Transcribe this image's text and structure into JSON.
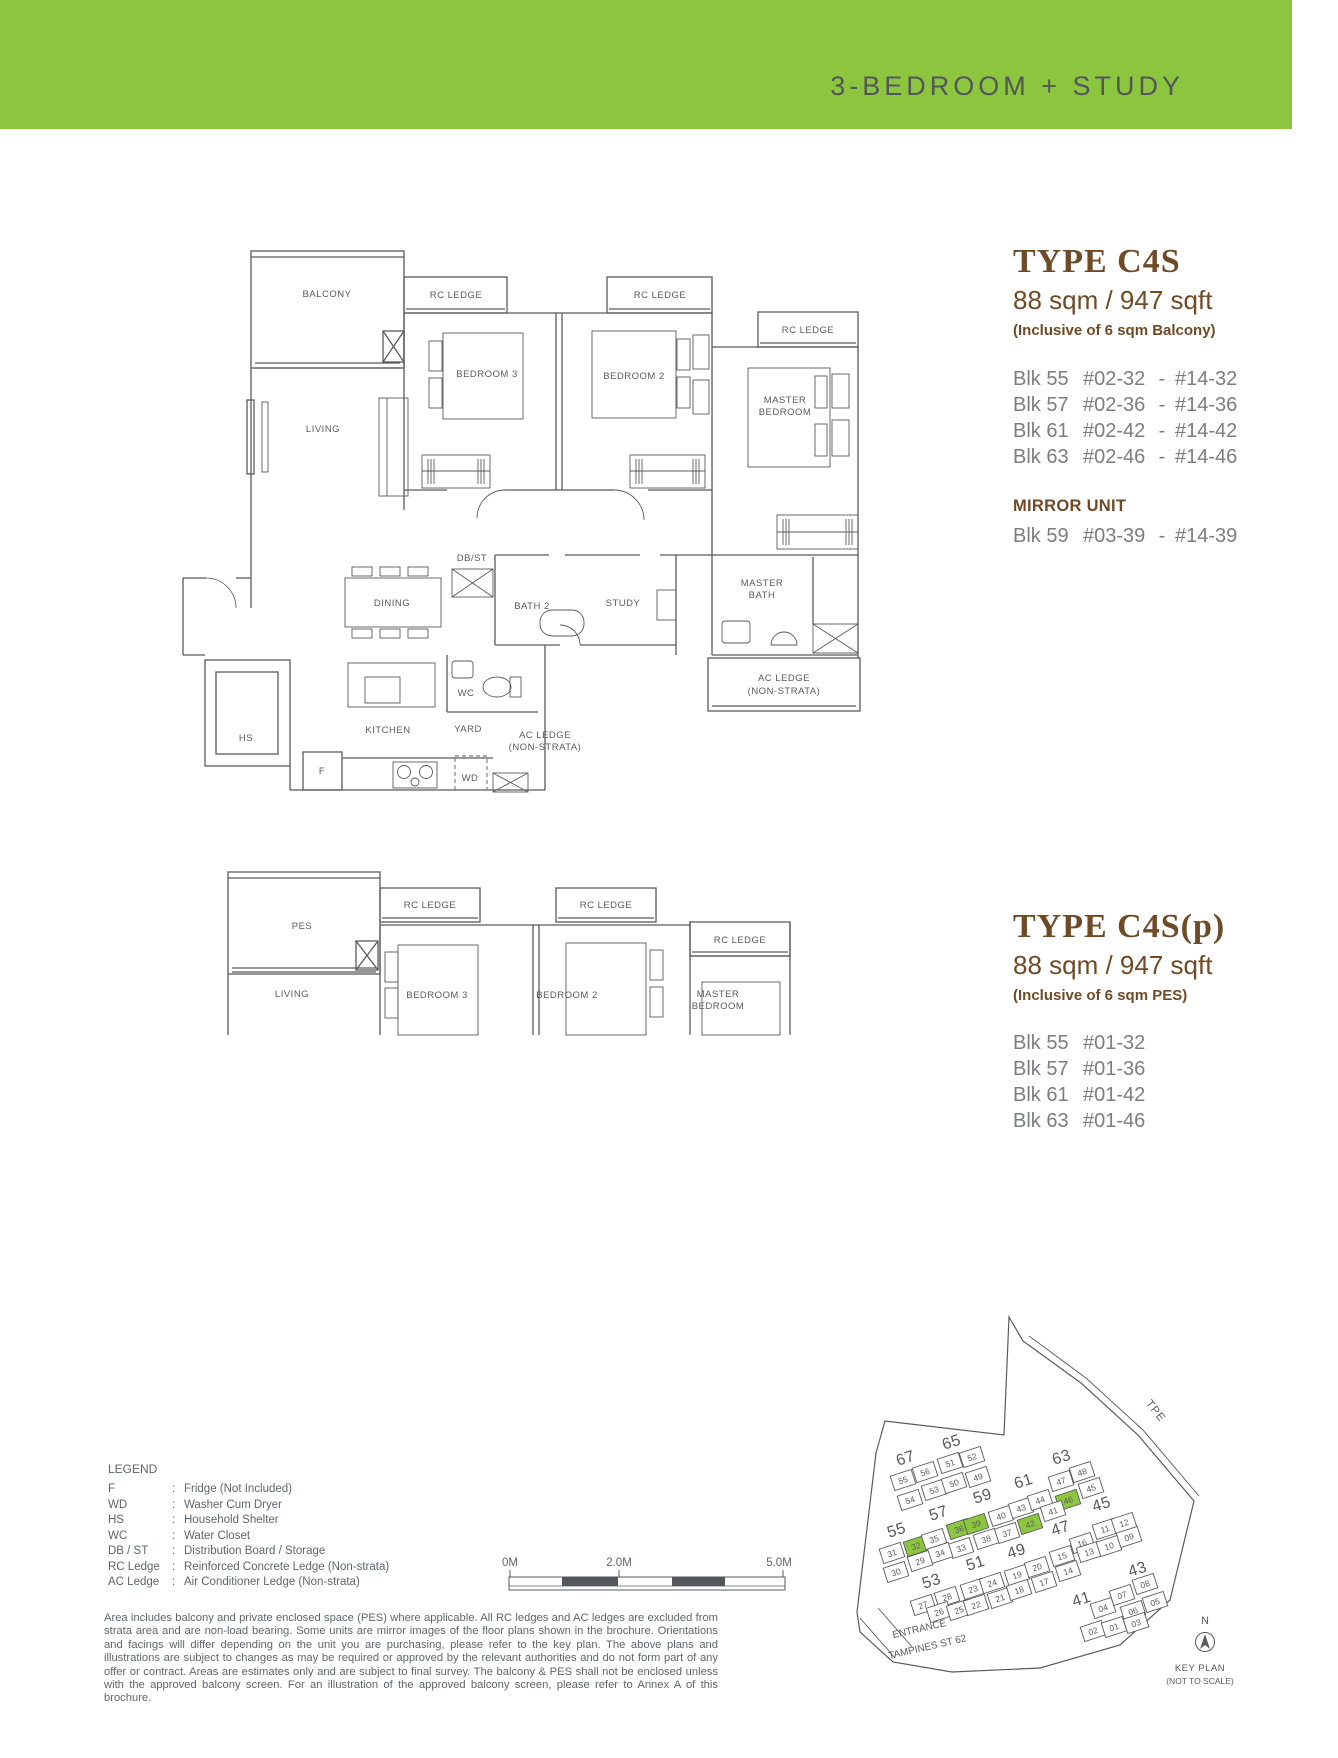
{
  "header": {
    "title": "3-BEDROOM + STUDY",
    "bg_color": "#8CC63F"
  },
  "type_c4s": {
    "title": "TYPE C4S",
    "area": "88 sqm / 947 sqft",
    "note": "(Inclusive of 6 sqm Balcony)",
    "range_separator": "-",
    "units": [
      {
        "blk": "Blk 55",
        "from": "#02-32",
        "to": "#14-32"
      },
      {
        "blk": "Blk 57",
        "from": "#02-36",
        "to": "#14-36"
      },
      {
        "blk": "Blk 61",
        "from": "#02-42",
        "to": "#14-42"
      },
      {
        "blk": "Blk 63",
        "from": "#02-46",
        "to": "#14-46"
      }
    ],
    "mirror_title": "MIRROR UNIT",
    "mirror_units": [
      {
        "blk": "Blk 59",
        "from": "#03-39",
        "to": "#14-39"
      }
    ]
  },
  "type_c4sp": {
    "title": "TYPE C4S(p)",
    "area": "88 sqm / 947 sqft",
    "note": "(Inclusive of 6 sqm PES)",
    "units": [
      {
        "blk": "Blk 55",
        "from": "#01-32"
      },
      {
        "blk": "Blk 57",
        "from": "#01-36"
      },
      {
        "blk": "Blk 61",
        "from": "#01-42"
      },
      {
        "blk": "Blk 63",
        "from": "#01-46"
      }
    ]
  },
  "floorplan_main": {
    "labels": [
      {
        "t": "BALCONY",
        "x": 327,
        "y": 297
      },
      {
        "t": "RC LEDGE",
        "x": 456,
        "y": 298
      },
      {
        "t": "RC LEDGE",
        "x": 660,
        "y": 298
      },
      {
        "t": "RC LEDGE",
        "x": 808,
        "y": 333
      },
      {
        "t": "BEDROOM 3",
        "x": 487,
        "y": 377
      },
      {
        "t": "BEDROOM 2",
        "x": 634,
        "y": 379
      },
      {
        "t": "MASTER",
        "x": 785,
        "y": 403
      },
      {
        "t": "BEDROOM",
        "x": 785,
        "y": 415
      },
      {
        "t": "LIVING",
        "x": 323,
        "y": 432
      },
      {
        "t": "DINING",
        "x": 392,
        "y": 606
      },
      {
        "t": "DB/ST",
        "x": 472,
        "y": 561,
        "fs": 9
      },
      {
        "t": "BATH 2",
        "x": 532,
        "y": 609
      },
      {
        "t": "STUDY",
        "x": 623,
        "y": 606
      },
      {
        "t": "MASTER",
        "x": 762,
        "y": 586
      },
      {
        "t": "BATH",
        "x": 762,
        "y": 598
      },
      {
        "t": "WC",
        "x": 466,
        "y": 696,
        "fs": 9
      },
      {
        "t": "HS",
        "x": 246,
        "y": 741
      },
      {
        "t": "KITCHEN",
        "x": 388,
        "y": 733
      },
      {
        "t": "YARD",
        "x": 468,
        "y": 732
      },
      {
        "t": "AC LEDGE",
        "x": 545,
        "y": 738,
        "fs": 9
      },
      {
        "t": "(NON-STRATA)",
        "x": 545,
        "y": 750,
        "fs": 9
      },
      {
        "t": "AC LEDGE",
        "x": 784,
        "y": 681
      },
      {
        "t": "(NON-STRATA)",
        "x": 784,
        "y": 694
      },
      {
        "t": "F",
        "x": 322,
        "y": 774,
        "fs": 9
      },
      {
        "t": "WD",
        "x": 470,
        "y": 781,
        "fs": 9
      }
    ]
  },
  "floorplan_pes": {
    "labels": [
      {
        "t": "PES",
        "x": 302,
        "y": 929
      },
      {
        "t": "RC LEDGE",
        "x": 430,
        "y": 908
      },
      {
        "t": "RC LEDGE",
        "x": 606,
        "y": 908
      },
      {
        "t": "RC LEDGE",
        "x": 740,
        "y": 943
      },
      {
        "t": "LIVING",
        "x": 292,
        "y": 997
      },
      {
        "t": "BEDROOM 3",
        "x": 437,
        "y": 998
      },
      {
        "t": "BEDROOM 2",
        "x": 567,
        "y": 998
      },
      {
        "t": "MASTER",
        "x": 718,
        "y": 997
      },
      {
        "t": "BEDROOM",
        "x": 718,
        "y": 1009
      }
    ]
  },
  "legend": {
    "title": "LEGEND",
    "items": [
      {
        "abbr": "F",
        "desc": "Fridge (Not Included)"
      },
      {
        "abbr": "WD",
        "desc": "Washer Cum Dryer"
      },
      {
        "abbr": "HS",
        "desc": "Household Shelter"
      },
      {
        "abbr": "WC",
        "desc": "Water Closet"
      },
      {
        "abbr": "DB / ST",
        "desc": "Distribution Board / Storage"
      },
      {
        "abbr": "RC Ledge",
        "desc": "Reinforced Concrete Ledge (Non-strata)"
      },
      {
        "abbr": "AC Ledge",
        "desc": "Air Conditioner Ledge (Non-strata)"
      }
    ]
  },
  "scalebar": {
    "labels": [
      "0M",
      "2.0M",
      "5.0M"
    ]
  },
  "disclaimer": "Area includes balcony and private enclosed space (PES) where applicable. All RC ledges and AC ledges are excluded from strata area and are non-load bearing. Some units are mirror images of the floor plans shown in the brochure. Orientations and facings will differ depending on the unit you are purchasing, please refer to the key plan. The above plans and illustrations are subject to changes as may be required or approved by the relevant authorities and do not form part of any offer or contract. Areas are estimates only and are subject to final survey. The balcony & PES shall not be enclosed unless with the approved balcony screen. For an illustration of the approved balcony screen, please refer to Annex A of this brochure.",
  "keyplan": {
    "road_label": "TPE",
    "entrance_line1": "ENTRANCE",
    "entrance_line2": "TAMPINES ST 62",
    "north_label": "N",
    "caption_line1": "KEY PLAN",
    "caption_line2": "(NOT TO SCALE)",
    "highlight_color": "#8CC63F",
    "blocks": [
      {
        "label": "67",
        "x": 907,
        "y": 1463
      },
      {
        "label": "65",
        "x": 953,
        "y": 1447
      },
      {
        "label": "55",
        "x": 898,
        "y": 1535
      },
      {
        "label": "57",
        "x": 940,
        "y": 1518
      },
      {
        "label": "59",
        "x": 984,
        "y": 1501
      },
      {
        "label": "61",
        "x": 1025,
        "y": 1486
      },
      {
        "label": "63",
        "x": 1063,
        "y": 1462
      },
      {
        "label": "47",
        "x": 1062,
        "y": 1533
      },
      {
        "label": "45",
        "x": 1103,
        "y": 1509
      },
      {
        "label": "53",
        "x": 933,
        "y": 1586
      },
      {
        "label": "51",
        "x": 977,
        "y": 1568
      },
      {
        "label": "49",
        "x": 1018,
        "y": 1556
      },
      {
        "label": "41",
        "x": 1083,
        "y": 1604
      },
      {
        "label": "43",
        "x": 1139,
        "y": 1574
      }
    ],
    "units": [
      {
        "n": "55",
        "x": 903,
        "y": 1480
      },
      {
        "n": "56",
        "x": 925,
        "y": 1472
      },
      {
        "n": "51",
        "x": 950,
        "y": 1463
      },
      {
        "n": "52",
        "x": 972,
        "y": 1457
      },
      {
        "n": "54",
        "x": 910,
        "y": 1500
      },
      {
        "n": "53",
        "x": 934,
        "y": 1490
      },
      {
        "n": "50",
        "x": 954,
        "y": 1483
      },
      {
        "n": "49",
        "x": 978,
        "y": 1477
      },
      {
        "n": "31",
        "x": 892,
        "y": 1553
      },
      {
        "n": "32",
        "x": 916,
        "y": 1546,
        "hl": true
      },
      {
        "n": "35",
        "x": 934,
        "y": 1539
      },
      {
        "n": "36",
        "x": 959,
        "y": 1529,
        "hl": true
      },
      {
        "n": "39",
        "x": 976,
        "y": 1524,
        "hl": true
      },
      {
        "n": "40",
        "x": 1001,
        "y": 1516
      },
      {
        "n": "43",
        "x": 1021,
        "y": 1508
      },
      {
        "n": "44",
        "x": 1040,
        "y": 1500
      },
      {
        "n": "47",
        "x": 1061,
        "y": 1481
      },
      {
        "n": "48",
        "x": 1082,
        "y": 1472
      },
      {
        "n": "45",
        "x": 1091,
        "y": 1488
      },
      {
        "n": "46",
        "x": 1068,
        "y": 1500,
        "hl": true
      },
      {
        "n": "41",
        "x": 1053,
        "y": 1511
      },
      {
        "n": "42",
        "x": 1030,
        "y": 1524,
        "hl": true
      },
      {
        "n": "37",
        "x": 1007,
        "y": 1533
      },
      {
        "n": "38",
        "x": 986,
        "y": 1539
      },
      {
        "n": "33",
        "x": 961,
        "y": 1548
      },
      {
        "n": "34",
        "x": 940,
        "y": 1553
      },
      {
        "n": "29",
        "x": 920,
        "y": 1561
      },
      {
        "n": "30",
        "x": 896,
        "y": 1572
      },
      {
        "n": "27",
        "x": 923,
        "y": 1605
      },
      {
        "n": "28",
        "x": 947,
        "y": 1597
      },
      {
        "n": "23",
        "x": 973,
        "y": 1589
      },
      {
        "n": "24",
        "x": 992,
        "y": 1583
      },
      {
        "n": "19",
        "x": 1017,
        "y": 1575
      },
      {
        "n": "20",
        "x": 1037,
        "y": 1567
      },
      {
        "n": "15",
        "x": 1062,
        "y": 1556
      },
      {
        "n": "16",
        "x": 1082,
        "y": 1543
      },
      {
        "n": "11",
        "x": 1105,
        "y": 1529
      },
      {
        "n": "12",
        "x": 1124,
        "y": 1523
      },
      {
        "n": "26",
        "x": 939,
        "y": 1612
      },
      {
        "n": "25",
        "x": 959,
        "y": 1610
      },
      {
        "n": "22",
        "x": 976,
        "y": 1605
      },
      {
        "n": "21",
        "x": 1000,
        "y": 1598
      },
      {
        "n": "18",
        "x": 1019,
        "y": 1590
      },
      {
        "n": "17",
        "x": 1044,
        "y": 1582
      },
      {
        "n": "14",
        "x": 1068,
        "y": 1571
      },
      {
        "n": "13",
        "x": 1089,
        "y": 1552
      },
      {
        "n": "10",
        "x": 1109,
        "y": 1546
      },
      {
        "n": "09",
        "x": 1129,
        "y": 1537
      },
      {
        "n": "04",
        "x": 1103,
        "y": 1608
      },
      {
        "n": "07",
        "x": 1122,
        "y": 1595
      },
      {
        "n": "08",
        "x": 1145,
        "y": 1584
      },
      {
        "n": "06",
        "x": 1133,
        "y": 1611
      },
      {
        "n": "05",
        "x": 1155,
        "y": 1602
      },
      {
        "n": "02",
        "x": 1093,
        "y": 1631
      },
      {
        "n": "01",
        "x": 1114,
        "y": 1627
      },
      {
        "n": "03",
        "x": 1136,
        "y": 1623
      }
    ]
  }
}
